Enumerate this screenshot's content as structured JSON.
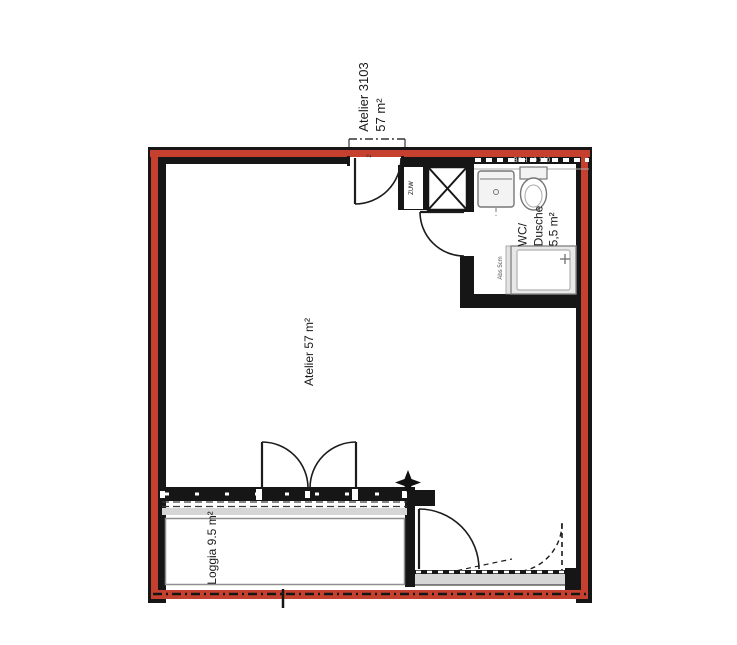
{
  "colors": {
    "outline": "#c5402e",
    "wall": "#161616"
  },
  "unit": {
    "name": "Atelier 3103",
    "area": "57 m²"
  },
  "rooms": {
    "atelier": "Atelier  57 m²",
    "wc": [
      "WC/",
      "Dusche",
      "5,5 m²"
    ],
    "loggia": "Loggia  9.5 m²"
  },
  "annotations": {
    "window_height": "BRH 40 130",
    "shaft": "ZUW",
    "shower": "Abs 5cm",
    "door": "2"
  }
}
